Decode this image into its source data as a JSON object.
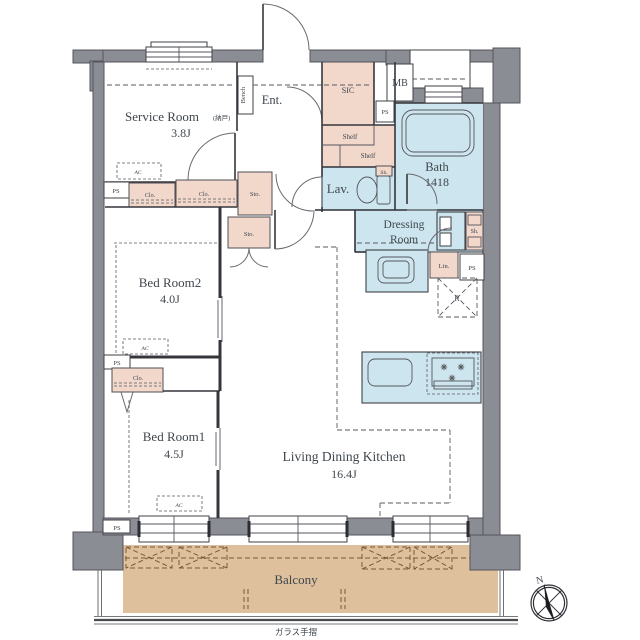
{
  "colors": {
    "wall": "#8b8d95",
    "pink": "#f2d7cb",
    "blue": "#cde5ee",
    "tan": "#dec09d",
    "tanline": "#7a5a38",
    "line": "#35363c",
    "text": "#3f474e"
  },
  "areas": {
    "service_room": {
      "name": "Service Room",
      "suffix": "(納戸)",
      "size": "3.8J"
    },
    "entrance": {
      "name": "Ent.",
      "bench": "Bench"
    },
    "sic": {
      "name": "SIC"
    },
    "mb": {
      "name": "MB"
    },
    "bath": {
      "name": "Bath",
      "size": "1418"
    },
    "washroom": {
      "lav": "Lav.",
      "shelf": "Shelf",
      "sh": "Sh."
    },
    "dressing": {
      "line1": "Dressing",
      "line2": "Room",
      "lin": "Lin.",
      "sh": "Sh."
    },
    "bed_room2": {
      "name": "Bed Room2",
      "size": "4.0J"
    },
    "bed_room1": {
      "name": "Bed Room1",
      "size": "4.5J"
    },
    "ldk": {
      "name": "Living Dining Kitchen",
      "size": "16.4J",
      "fridge_mark": "R"
    },
    "storage": {
      "sto": "Sto.",
      "clo": "Clo.",
      "ps": "PS",
      "ac": "AC"
    },
    "balcony": {
      "name": "Balcony",
      "rail_note": "ガラス手摺"
    },
    "compass": {
      "north": "N"
    }
  }
}
